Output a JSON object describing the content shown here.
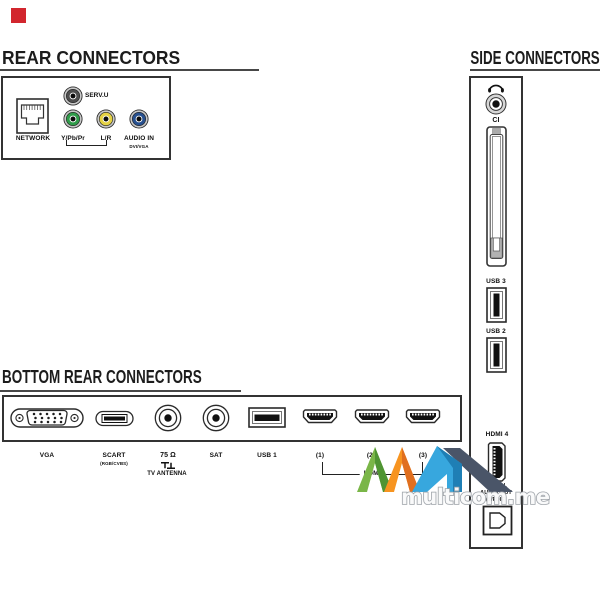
{
  "marker": {
    "color": "#d2262e"
  },
  "rear": {
    "title": "REAR CONNECTORS",
    "network_label": "NETWORK",
    "jacks": [
      {
        "label": "SERV.U",
        "color": "#4e4e4e"
      },
      {
        "label": "Y/Pb/Pr",
        "color": "#2f9b49"
      },
      {
        "label": "L/R",
        "color": "#e5d244"
      },
      {
        "label": "AUDIO IN",
        "sublabel": "DVI/VGA",
        "color": "#27508f"
      }
    ]
  },
  "bottom": {
    "title": "BOTTOM REAR CONNECTORS",
    "vga_label": "VGA",
    "scart_label": "SCART",
    "scart_sublabel": "(RGB/CVBS)",
    "antenna_label": "75 Ω",
    "antenna_sublabel": "TV ANTENNA",
    "sat_label": "SAT",
    "usb1_label": "USB 1",
    "hdmi_labels": [
      "(1)",
      "(2)",
      "(3)"
    ],
    "hdmi_group_label": "HDMI"
  },
  "side": {
    "title": "SIDE CONNECTORS",
    "ci_label": "CI",
    "usb3_label": "USB 3",
    "usb2_label": "USB 2",
    "hdmi4_label": "HDMI 4",
    "digital_out_line1": "DIGITAL",
    "digital_out_line2": "AUDIO OUT",
    "digital_out_line3": "(S/PDIF)"
  },
  "watermark": {
    "text": "multicom.me",
    "logo_colors": {
      "green": "#7ab648",
      "green_dark": "#4f9433",
      "orange": "#f79420",
      "orange_dark": "#e06f1f",
      "blue": "#37a7de",
      "blue_dark": "#1f7fb5",
      "slate": "#4a5568"
    }
  }
}
